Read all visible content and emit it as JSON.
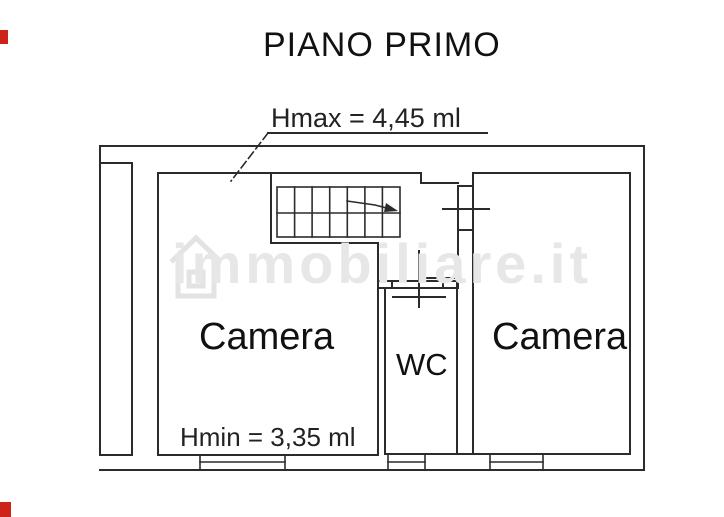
{
  "title": "PIANO PRIMO",
  "annotations": {
    "hmax": "Hmax = 4,45 ml",
    "hmin": "Hmin = 3,35 ml"
  },
  "rooms": {
    "camera_left": "Camera",
    "camera_right": "Camera",
    "wc": "WC"
  },
  "watermark": "immobiliare.it",
  "colors": {
    "line": "#2b2b2b",
    "watermark": "#e7e7e7",
    "red_mark": "#cc2418",
    "background": "#ffffff"
  }
}
